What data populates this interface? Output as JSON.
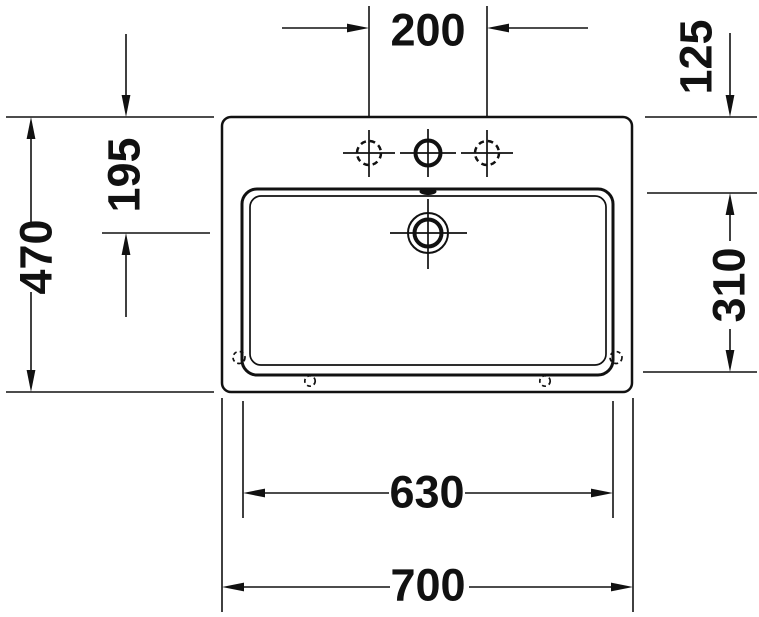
{
  "drawing": {
    "description": "Technical dimension drawing of a rectangular washbasin, top view",
    "background_color": "#ffffff",
    "line_color": "#111111",
    "dimensions": {
      "tap_hole_spacing": "200",
      "back_ledge_depth": "125",
      "edge_to_drain_center": "195",
      "overall_depth": "470",
      "basin_inner_depth": "310",
      "basin_inner_width": "630",
      "overall_width": "700"
    }
  }
}
